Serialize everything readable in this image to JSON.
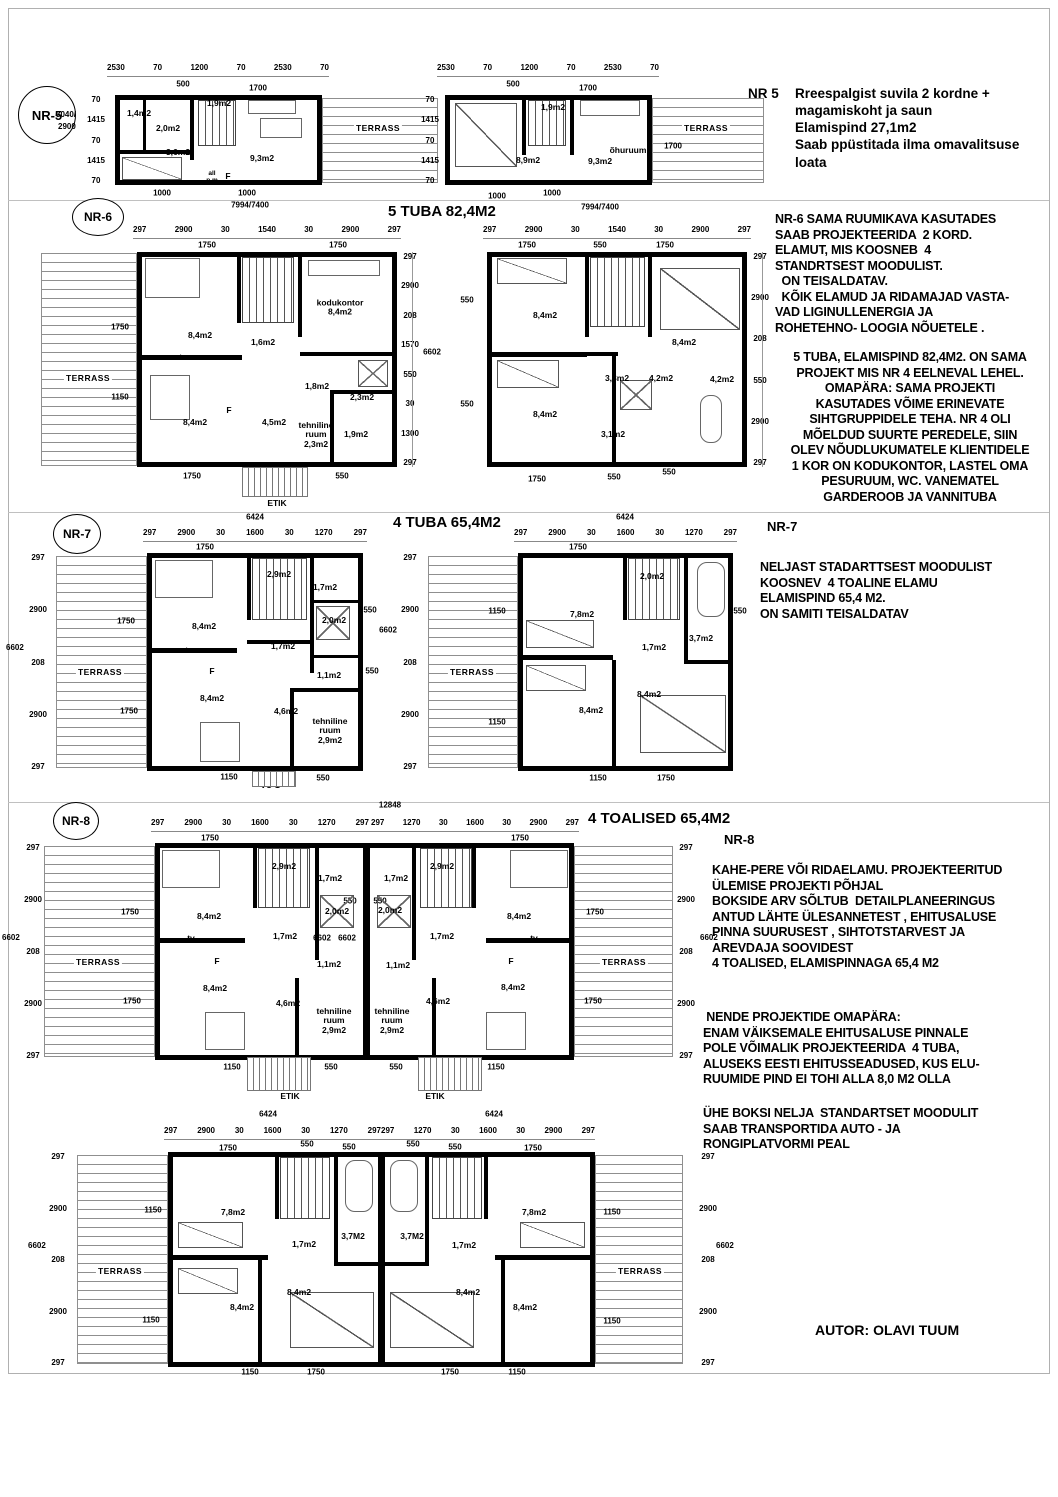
{
  "page": {
    "author": "AUTOR: OLAVI TUUM"
  },
  "common": {
    "dims_a": [
      "297",
      "2900",
      "30",
      "1600",
      "30",
      "1270",
      "297"
    ],
    "dims_b": [
      "297",
      "1270",
      "30",
      "1600",
      "30",
      "2900",
      "297"
    ],
    "dims_side": [
      "297",
      "2900",
      "208",
      "2900",
      "297"
    ],
    "d6602": "6602",
    "d6424": "6424",
    "d1750": "1750",
    "d1150": "1150",
    "d550": "550",
    "terrass": "TERRASS",
    "etik": "ETIK"
  },
  "nr5": {
    "badge": "NR-5",
    "note_id": "NR 5",
    "note_lines": [
      "Rreespalgist suvila 2 kordne  +",
      "magamiskoht ja saun",
      "Elamispind 27,1m2",
      "Saab ppüstitada ilma omavalitsuse",
      "loata"
    ],
    "dims_top": [
      "2530",
      "70",
      "1200",
      "70",
      "2530",
      "70"
    ],
    "dims_left": [
      "70",
      "1415",
      "70",
      "1415",
      "70"
    ],
    "total_left_1": "3040/",
    "total_left_2": "2900",
    "d500": "500",
    "d1700": "1700",
    "d1000": "1000",
    "total_bottom": "7994/7400",
    "f1": {
      "sauna": "1,4m2",
      "shower": "2,0m2",
      "stairs": "1,9m2",
      "bedroom": "3,6m2",
      "living": "9,3m2",
      "all": "all",
      "pm": "p.m",
      "f": "F"
    },
    "f2": {
      "stairs": "1,9m2",
      "bedroom": "8,9m2",
      "living": "9,3m2",
      "ohuruum": "õhuruum"
    }
  },
  "nr6": {
    "badge": "NR-6",
    "title": "5 TUBA 82,4M2",
    "dims_top": [
      "297",
      "2900",
      "30",
      "1540",
      "30",
      "2900",
      "297"
    ],
    "note_a": [
      "NR-6 SAMA RUUMIKAVA KASUTADES",
      "SAAB PROJEKTEERIDA  2 KORD.",
      "ELAMUT, MIS KOOSNEB  4",
      "STANDRTSEST MOODULIST.",
      "  ON TEISALDATAV.",
      "  KÕIK ELAMUD JA RIDAMAJAD VASTA-",
      "VAD LIGINULLENERGIA JA",
      "ROHETEHNO- LOOGIA NÕUETELE ."
    ],
    "note_b": [
      "5 TUBA, ELAMISPIND 82,4M2. ON SAMA",
      "PROJEKT MIS NR 4 EELNEVAL LEHEL.",
      "OMAPÄRA: SAMA PROJEKTI",
      "KASUTADES VÕIME ERINEVATE",
      "SIHTGRUPPIDELE TEHA. NR 4 OLI",
      "MÕELDUD SUURTE PEREDELE, SIIN",
      "OLEV NÕUDLUKUMATELE KLIENTIDELE",
      "1 KOR ON KODUKONTOR, LASTEL OMA",
      "PESURUUM, WC. VANEMATEL",
      "GARDEROOB JA VANNITUBA"
    ],
    "f1": {
      "sub1": "1750",
      "sub2": "1750",
      "dims_right": [
        "297",
        "2900",
        "208",
        "1570",
        "550",
        "30",
        "1300",
        "297"
      ],
      "in_l1": "1750",
      "in_l2": "1150",
      "living": "8,4m2",
      "office_name": "kodukontor",
      "office_area": "8,4m2",
      "hall": "1,6m2",
      "tv": "tv",
      "kitchen": "8,4m2",
      "f": "F",
      "dining": "4,5m2",
      "wc": "1,8m2",
      "shower": "2,3m2",
      "tech_1": "tehniline",
      "tech_2": "ruum",
      "tech_3": "2,3m2",
      "laundry": "1,9m2",
      "b1": "1750",
      "b2": "1150",
      "b3": "550"
    },
    "f2": {
      "sub1": "1750",
      "sub2": "550",
      "sub3": "1750",
      "dims_right": [
        "297",
        "2900",
        "208",
        "550",
        "2900",
        "297"
      ],
      "l1": "550",
      "l2": "550",
      "bed1": "8,4m2",
      "bed2": "8,4m2",
      "bed3": "8,4m2",
      "hall": "3,3m2",
      "bath": "4,2m2",
      "wardrobe": "4,2m2",
      "wc": "3,1m2",
      "b1": "1750",
      "b2": "550",
      "b3": "550"
    }
  },
  "module1": {
    "living": "8,4m2",
    "tv": "tv",
    "f": "F",
    "kitchen": "8,4m2",
    "stairs": "2,9m2",
    "wc": "1,7m2",
    "shower": "2,0m2",
    "hall": "1,7m2",
    "bath": "1,1m2",
    "storage": "4,6m2",
    "tech_1": "tehniline",
    "tech_2": "ruum",
    "tech_3": "2,9m2"
  },
  "module2": {
    "bed1": "7,8m2",
    "stairs": "2,0m2",
    "bath": "3,7m2",
    "bath_u": "3,7M2",
    "hall": "1,7m2",
    "bed2": "8,4m2",
    "bed3": "8,4m2"
  },
  "nr7": {
    "badge": "NR-7",
    "label": "NR-7",
    "title": "4 TUBA 65,4M2",
    "note_lines": [
      "NELJAST STADARTTSEST MOODULIST",
      "KOOSNEV  4 TOALINE ELAMU",
      "ELAMISPIND 65,4 M2.",
      "ON SAMITI TEISALDATAV"
    ],
    "f1": {
      "sub": "1750",
      "in1": "1750",
      "in2": "1750",
      "r1": "550",
      "r2": "550",
      "vu": "VU-1",
      "b1": "1150",
      "b2": "550"
    },
    "f2": {
      "sub": "1750",
      "in1": "1150",
      "in2": "1150",
      "r1": "550",
      "b1": "1150",
      "b2": "1750"
    }
  },
  "nr8": {
    "badge": "NR-8",
    "label": "NR-8",
    "title": "4 TOALISED 65,4M2",
    "total_top": "12848",
    "note_1": [
      "KAHE-PERE VÕI RIDAELAMU. PROJEKTEERITUD",
      "ÜLEMISE PROJEKTI PÕHJAL",
      "BOKSIDE ARV SÕLTUB  DETAILPLANEERINGUS",
      "ANTUD LÄHTE ÜLESANNETEST , EHITUSALUSE",
      "PINNA SUURUSEST , SIHTOTSTARVEST JA",
      "AREVDAJA SOOVIDEST",
      "4 TOALISED, ELAMISPINNAGA 65,4 M2"
    ],
    "note_2": [
      " NENDE PROJEKTIDE OMAPÄRA:",
      "ENAM VÄIKSEMALE EHITUSALUSE PINNALE",
      "POLE VÕIMALIK PROJEKTEERIDA  4 TUBA,",
      "ALUSEKS EESTI EHITUSSEADUSED, KUS ELU-",
      "RUUMIDE PIND EI TOHI ALLA 8,0 M2 OLLA"
    ],
    "note_3": [
      "ÜHE BOKSI NELJA  STANDARTSET MOODULIT",
      "SAAB TRANSPORTIDA AUTO - JA",
      "RONGIPLATVORMI PEAL"
    ]
  }
}
